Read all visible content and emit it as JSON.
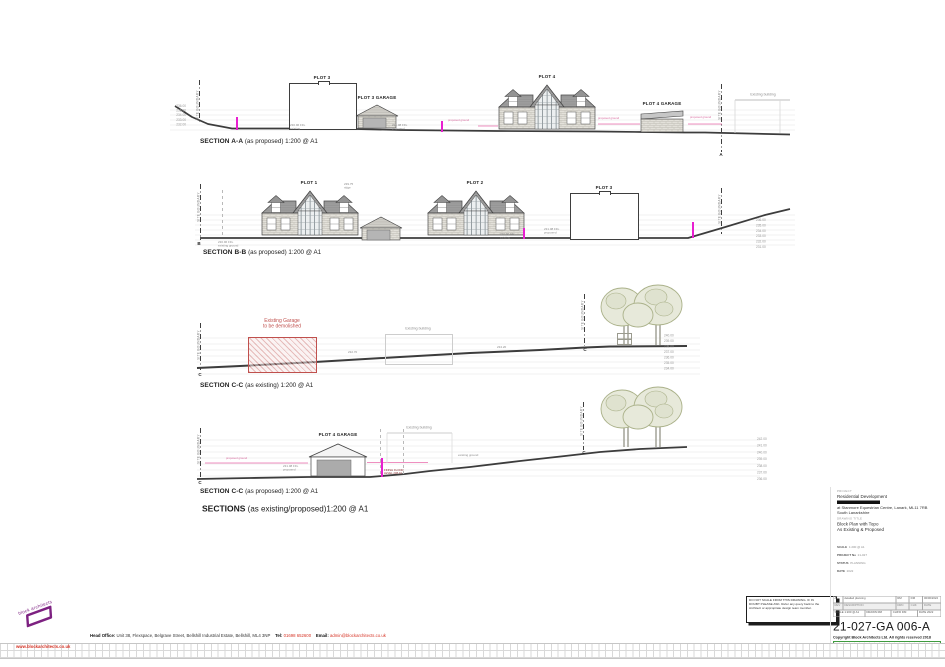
{
  "sections": {
    "aa": {
      "name_bold": "SECTION A-A",
      "name_rest": " (as proposed) 1:200 @ A1",
      "plot3": "PLOT 3",
      "plot3_garage": "PLOT 3 GARAGE",
      "plot4": "PLOT 4",
      "plot4_garage": "PLOT 4 GARAGE",
      "existing_building": "Existing building",
      "marker": "A",
      "boundary": "SITE BOUNDARY",
      "levels_left": [
        "236.00",
        "235.00",
        "234.00",
        "233.00",
        "232.00"
      ]
    },
    "bb": {
      "name_bold": "SECTION B-B",
      "name_rest": " (as proposed) 1:200 @ A1",
      "plot1": "PLOT 1",
      "plot2": "PLOT 2",
      "plot3": "PLOT 3",
      "marker": "B",
      "boundary": "SITE BOUNDARY",
      "levels_right": [
        "236.00",
        "235.00",
        "234.00",
        "233.00",
        "232.00",
        "231.00"
      ]
    },
    "cc_existing": {
      "name_bold": "SECTION C-C",
      "name_rest": " (as existing) 1:200 @ A1",
      "demolish_1": "Existing Garage",
      "demolish_2": "to be demolished",
      "existing_building": "Existing building",
      "marker": "C",
      "boundary": "SITE BOUNDARY",
      "levels_right": [
        "240.00",
        "239.00",
        "238.00",
        "237.00",
        "236.00",
        "235.00",
        "234.00"
      ]
    },
    "cc_proposed": {
      "name_bold": "SECTION C-C",
      "name_rest": " (as proposed) 1:200 @ A1",
      "plot4_garage": "PLOT 4 GARAGE",
      "existing_building": "Existing building",
      "marker": "C",
      "boundary": "SITE BOUNDARY",
      "levels_right": [
        "242.00",
        "241.00",
        "240.00",
        "239.00",
        "238.00",
        "237.00",
        "236.00"
      ]
    }
  },
  "micro": {
    "aa_ffl1": "230.96 FFL\nexisting",
    "aa_ffl2": "231.08 FFL\nproposed",
    "bb_ffl_left": "230.96 FFL\nexisting ground",
    "bb_ridge": "239.75\nridge",
    "bb_ffl1": "230.96 FFL\nexisting",
    "bb_ffl2": "231.08 FFL\nproposed",
    "cce_lv1": "232.70",
    "cce_lv2": "234.20",
    "ccp_ffl": "231.08 FFL\nproposed",
    "ccp_ffl_red": "FINISH FLOOR\nLEVEL 238.10",
    "pgl": "proposed ground",
    "ground_note": "existing ground"
  },
  "main_title": {
    "bold": "SECTIONS",
    "rest": " (as existing/proposed)1:200 @ A1"
  },
  "note_box": {
    "line1": "DO NOT SCALE FROM THIS DRAWING. IF IN",
    "line2": "DOUBT PLEASE ASK. Refer any query back to the",
    "line3": "Architect or appropriate design team member."
  },
  "title_block": {
    "project_label": "PROJECT",
    "project_name": "Residential Development",
    "project_addr1": "at Stanmore Equestrian Centre, Lanark, ML11 7RB",
    "project_addr2": "South Lanarkshire",
    "title_label": "DRAWING TITLE",
    "title_line1": "Block Plan with Topo",
    "title_line2": "As Existing & Proposed",
    "meta": [
      {
        "label": "SCALE",
        "value": "1:200 @ A1"
      },
      {
        "label": "PROJECT No",
        "value": "21-027"
      },
      {
        "label": "STATUS",
        "value": "PLANNING"
      },
      {
        "label": "DATE",
        "value": "2022"
      }
    ],
    "revision_row": [
      "A",
      "detailed planning",
      "RM",
      "DM",
      "00/00/2022"
    ],
    "revision_headers": [
      "REV",
      "DESCRIPTION",
      "DRN",
      "CHK",
      "DATE"
    ],
    "info_row": [
      "SCALE 1:200 @ A1",
      "DRAWN RM",
      "CHK'D DM",
      "DATE 2022"
    ],
    "drawing_number": "21-027-GA 006-A",
    "copyright": "Copyright Block Architects Ltd. All rights reserved 2018",
    "recycle_icon": "♻",
    "eco_note": "Please consider the environment before printing this drawing"
  },
  "footer": {
    "logo_text": "block architects",
    "website": "www.blockarchitects.co.uk",
    "head_office_label": "Head Office:",
    "head_office": " Unit 38, Flexspace, Belgrave Street, Bellshill Industrial Estate, Bellshill, ML4 3NP",
    "tel_label": "Tel:",
    "tel": "01698 652600",
    "email_label": "Email:",
    "email": "admin@blockarchitects.co.uk"
  },
  "colors": {
    "accent_purple": "#7d2181",
    "red_text": "#d63426",
    "magenta_marker": "#e81fd0",
    "demolition_red": "#c0504d",
    "eco_green": "#2e7d32",
    "roof_gray": "#9e9e9e",
    "tree_fill": "#e7e9da"
  }
}
